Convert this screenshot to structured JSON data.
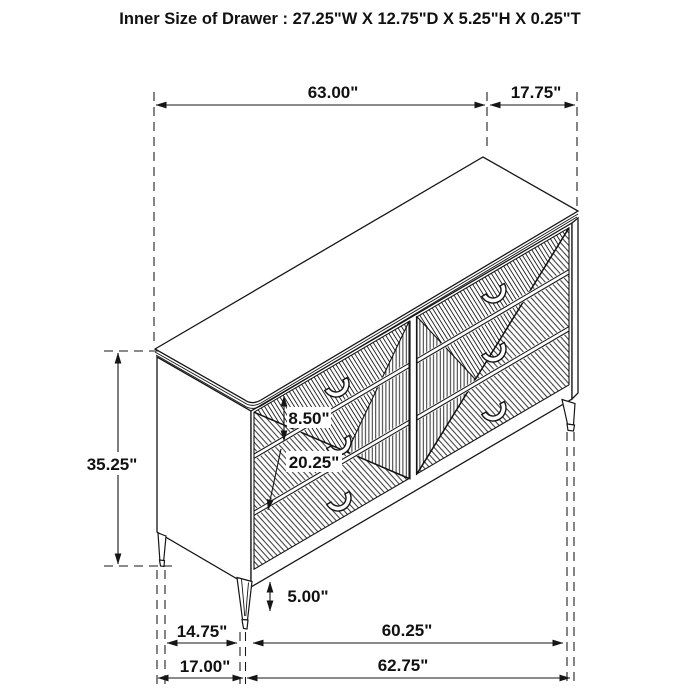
{
  "title": "Inner Size of Drawer : 27.25\"W X 12.75\"D X 5.25\"H X 0.25\"T",
  "dims": {
    "top_width": "63.00\"",
    "top_depth": "17.75\"",
    "overall_height": "35.25\"",
    "top_drawer_height": "8.50\"",
    "lower_section_height": "20.25\"",
    "leg_height": "5.00\"",
    "leg_depth_span": "14.75\"",
    "leg_width_span": "60.25\"",
    "base_depth": "17.00\"",
    "base_width": "62.75\""
  },
  "colors": {
    "line": "#161616",
    "background": "#ffffff"
  }
}
